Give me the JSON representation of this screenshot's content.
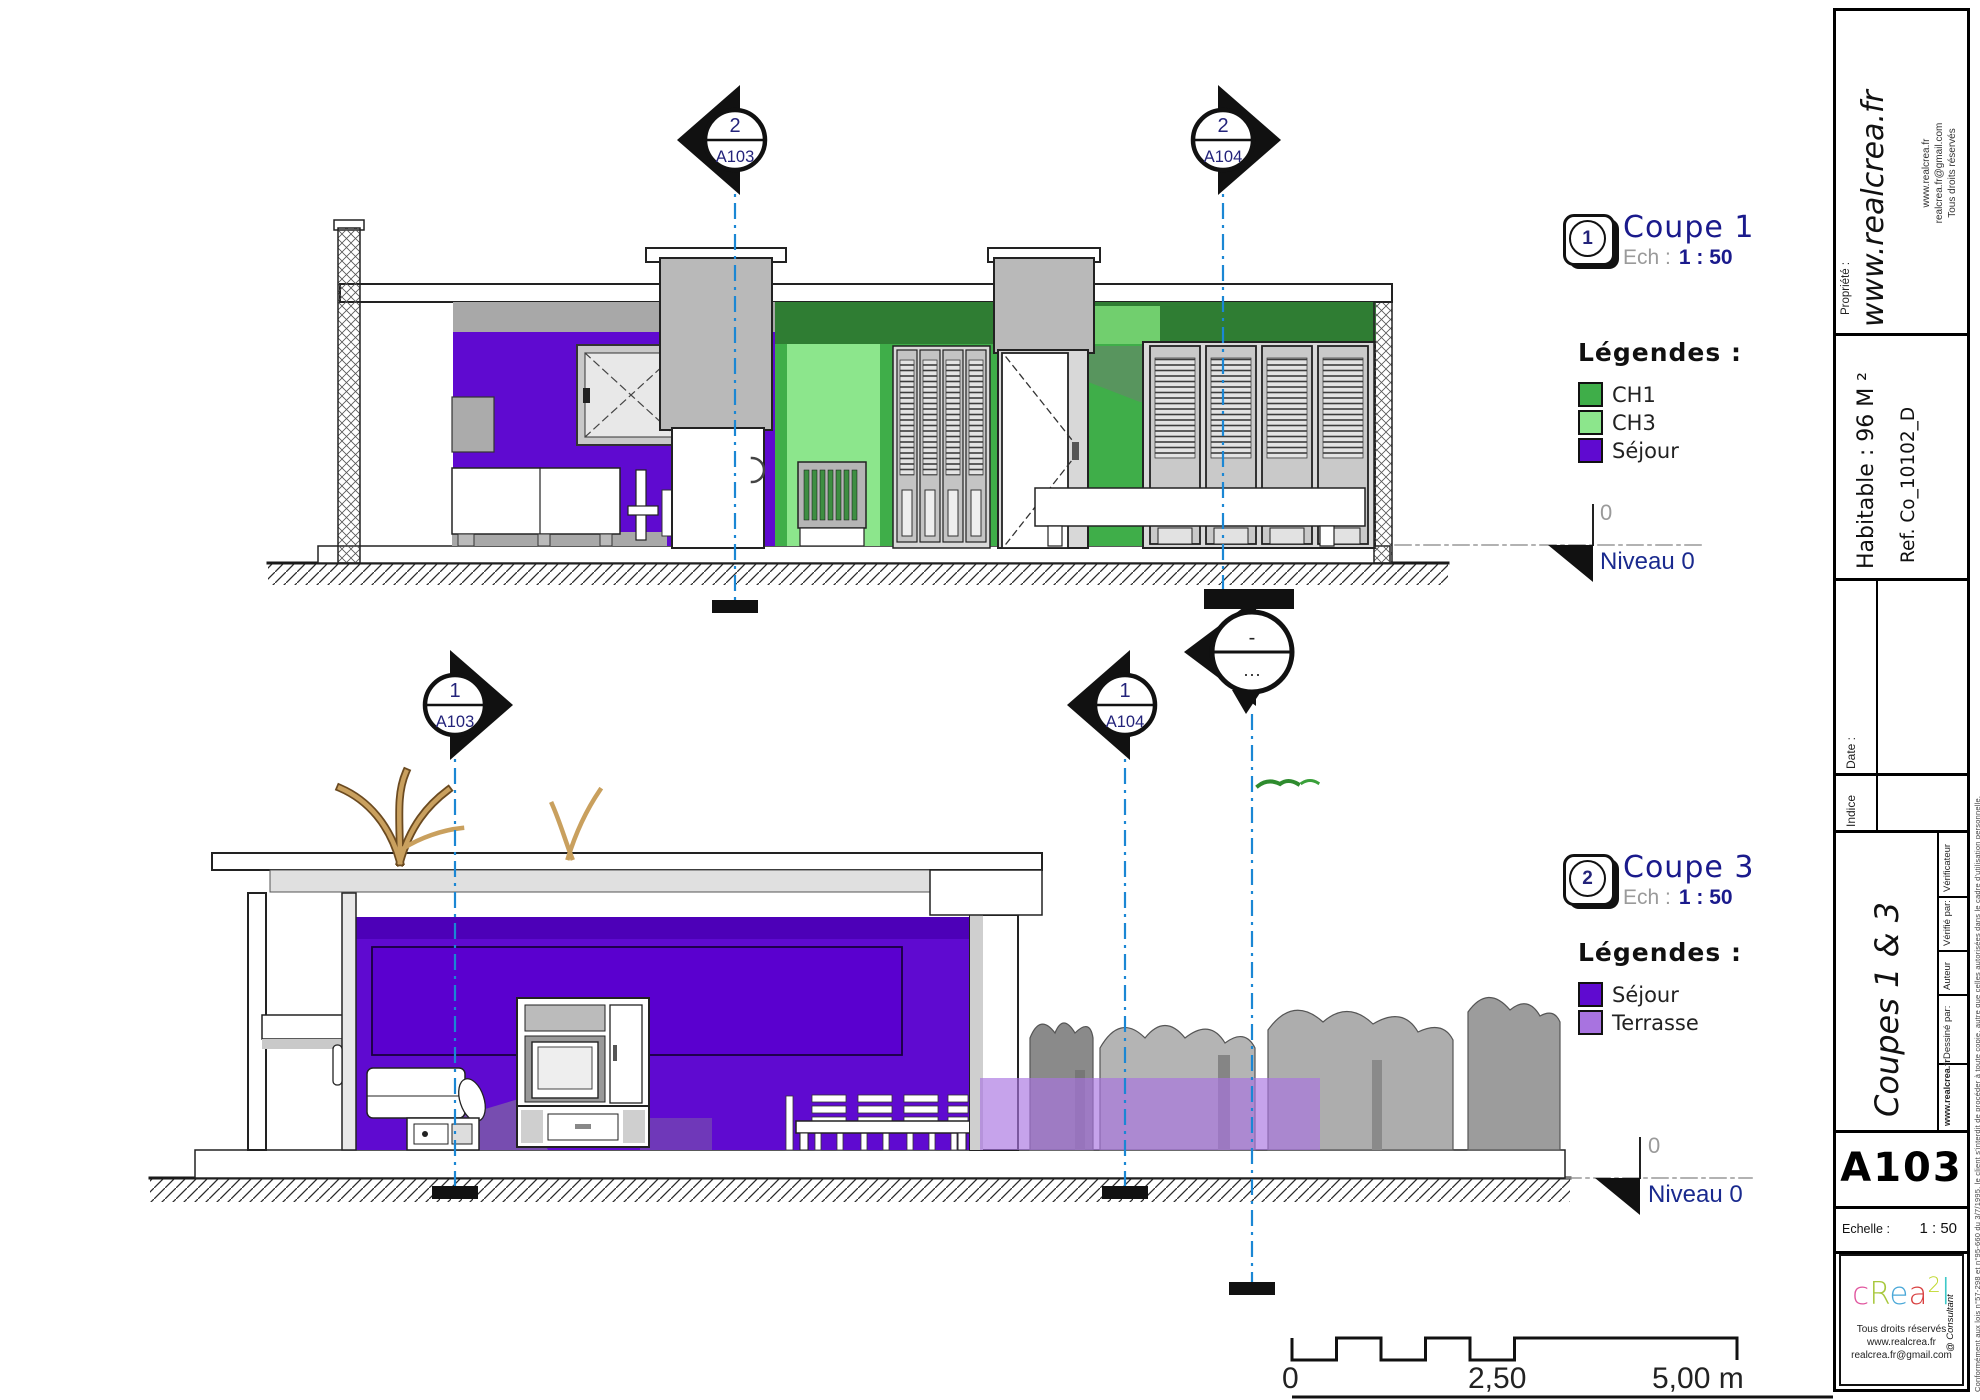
{
  "colors": {
    "ch1": "#3fae49",
    "ch3": "#8ce68c",
    "sejour": "#5f0ad0",
    "terrasse": "#a873e0",
    "section_line": "#1b87d4",
    "navy": "#1a1a8c"
  },
  "views": [
    {
      "id": "coupe1",
      "callout": {
        "number": "1",
        "title": "Coupe 1",
        "scale_label": "Ech :",
        "scale_value": "1 : 50"
      },
      "legend": {
        "heading": "Légendes :",
        "items": [
          {
            "label": "CH1",
            "color": "#3fae49"
          },
          {
            "label": "CH3",
            "color": "#8ce68c"
          },
          {
            "label": "Séjour",
            "color": "#5f0ad0"
          }
        ]
      },
      "level": {
        "value": "0",
        "label": "Niveau 0"
      },
      "markers": [
        {
          "number": "2",
          "sheet": "A103"
        },
        {
          "number": "2",
          "sheet": "A104"
        }
      ]
    },
    {
      "id": "coupe3",
      "callout": {
        "number": "2",
        "title": "Coupe 3",
        "scale_label": "Ech :",
        "scale_value": "1 : 50"
      },
      "legend": {
        "heading": "Légendes :",
        "items": [
          {
            "label": "Séjour",
            "color": "#5f0ad0"
          },
          {
            "label": "Terrasse",
            "color": "#a873e0"
          }
        ]
      },
      "level": {
        "value": "0",
        "label": "Niveau 0"
      },
      "markers": [
        {
          "number": "1",
          "sheet": "A103"
        },
        {
          "number": "1",
          "sheet": "A104"
        }
      ]
    }
  ],
  "mid_marker": {
    "top": "-",
    "bottom": "···"
  },
  "scale_bar": {
    "labels": [
      "0",
      "2,50",
      "5,00 m"
    ]
  },
  "title_block": {
    "propriete_label": "Propriété :",
    "website_large": "www.realcrea.fr",
    "contact_lines": [
      "www.realcrea.fr",
      "realcrea.fr@gmail.com",
      "Tous droits réservés"
    ],
    "habitable": "Habitable : 96 M ²",
    "reference": "Ref. Co_10102_D",
    "revision": {
      "date_label": "Date :",
      "indice_label": "Indice"
    },
    "credits": {
      "verificateur": "Vérificateur",
      "verifie_par": "Vérifié par:",
      "auteur": "Auteur",
      "dessine_par": "Dessiné par:",
      "statut": "www.realcrea.fr"
    },
    "sheet_title": "Coupes 1 & 3",
    "sheet_number": "A103",
    "echelle_label": "Echelle :",
    "echelle_value": "1 : 50",
    "logo": {
      "letters": [
        {
          "ch": "c",
          "color": "#e0559e"
        },
        {
          "ch": "R",
          "color": "#a8c83c"
        },
        {
          "ch": "e",
          "color": "#4aa8d8"
        },
        {
          "ch": "a",
          "color": "#d84040"
        },
        {
          "ch": "2",
          "color": "#c0d82e"
        },
        {
          "ch": "l",
          "color": "#3ec8c8"
        }
      ],
      "consultant": "@ Consultant"
    },
    "footer_lines": [
      "Tous droits réservés",
      "www.realcrea.fr",
      "realcrea.fr@gmail.com"
    ],
    "fine_print": "Conformément aux lois n°57-298 et n°95-660 du 3/7/1995, le client s'interdit de procéder à toute copie, autre que celles autorisées dans le cadre d'utilisation personnelle."
  }
}
